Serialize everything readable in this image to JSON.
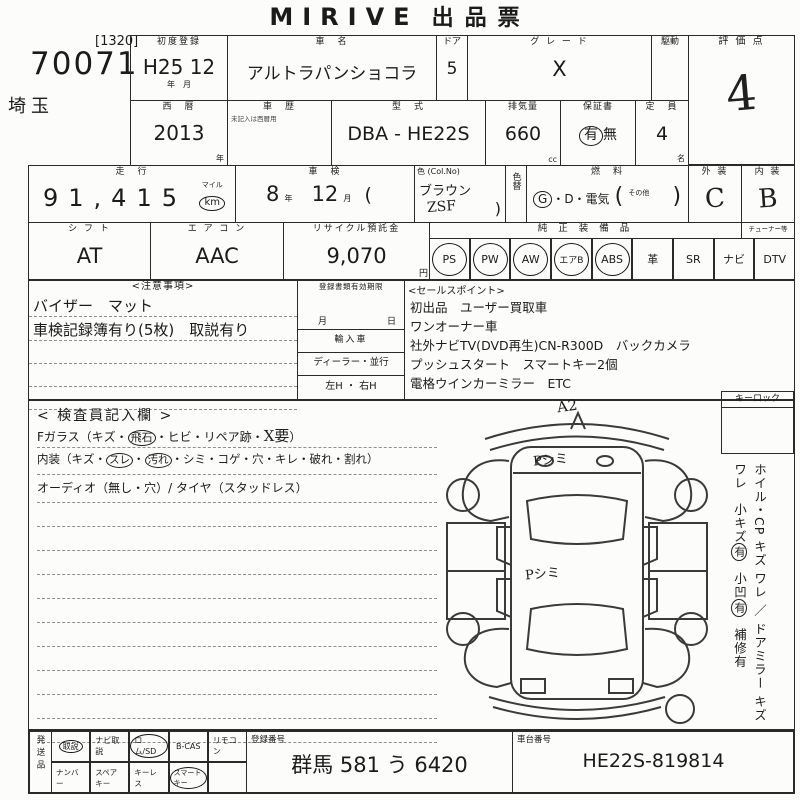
{
  "title": {
    "latin": "MIRIVE",
    "jp": "出品票"
  },
  "corner": {
    "bracket": "[1320]",
    "lot": "70071",
    "pref": "埼玉"
  },
  "r1": {
    "first_reg_label": "初度登録",
    "first_reg": "H25 12",
    "first_reg_unit": "年　月",
    "name_label": "車　名",
    "name": "アルトラパンショコラ",
    "door_label": "ドア",
    "door": "5",
    "grade_label": "グ レ ー ド",
    "grade": "X",
    "drive_label": "駆動",
    "score_label": "評 価 点",
    "score": "4"
  },
  "r2": {
    "year_label": "西　暦",
    "year": "2013",
    "year_unit": "年",
    "hist_label": "車　歴",
    "hist_note": "未記入は西暦用",
    "model_label": "型　式",
    "model": "DBA - HE22S",
    "disp_label": "排気量",
    "disp": "660",
    "disp_unit": "cc",
    "warr_label": "保証書",
    "warr_yes": "有",
    "warr_no": "無",
    "cap_label": "定　員",
    "cap": "4",
    "cap_unit": "名"
  },
  "r3": {
    "run_label": "走　行",
    "run": "91,415",
    "run_unit_a": "マイル",
    "run_unit_b": "km",
    "shaken_label": "車　検",
    "shaken_y": "8",
    "shaken_y_u": "年",
    "shaken_m": "12",
    "shaken_m_u": "月",
    "paren_open": "(",
    "color_label": "色 (Col.No)",
    "color": "ブラウン",
    "color_code": "ZSF",
    "paren_close": ")",
    "recolor_label": "色替",
    "fuel_label": "燃　料",
    "fuel_g": "G",
    "fuel_rest": "・D・電気",
    "fuel_po": "(",
    "fuel_other": "その他",
    "fuel_pc": ")",
    "ext_label": "外 装",
    "ext": "C",
    "int_label": "内 装",
    "int": "B"
  },
  "r4": {
    "shift_label": "シ フ ト",
    "shift": "AT",
    "ac_label": "エ ア コ ン",
    "ac": "AAC",
    "recycle_label": "リサイクル預託金",
    "recycle": "9,070",
    "recycle_unit": "円",
    "equip_label": "純 正 装 備 品",
    "tuner_label": "チューナー等",
    "equip": [
      {
        "label": "PS",
        "on": true
      },
      {
        "label": "PW",
        "on": true
      },
      {
        "label": "AW",
        "on": true
      },
      {
        "label": "エアB",
        "on": true
      },
      {
        "label": "ABS",
        "on": true
      },
      {
        "label": "革",
        "on": false
      },
      {
        "label": "SR",
        "on": false
      },
      {
        "label": "ナビ",
        "on": false
      },
      {
        "label": "DTV",
        "on": false
      }
    ]
  },
  "notes": {
    "label": "<注意事項>",
    "line1": "バイザー　マット",
    "line2": "車検記録簿有り(5枚)　取説有り"
  },
  "docs": {
    "validity_label": "登録書類有効期限",
    "month": "月",
    "day": "日",
    "import_label": "輸入車",
    "dealer": "ディーラー・並行",
    "handle": "左H ・ 右H"
  },
  "sales": {
    "label": "<セールスポイント>",
    "lines": [
      "初出品　ユーザー買取車",
      "ワンオーナー車",
      "社外ナビTV(DVD再生)CN-R300D　バックカメラ",
      "プッシュスタート　スマートキー2個",
      "電格ウインカーミラー　ETC"
    ]
  },
  "inspector": {
    "label": "< 検査員記入欄 >",
    "l1a": "Fガラス（キズ・",
    "l1c": "飛石",
    "l1b": "・ヒビ・リペア跡・",
    "l1h": "X要",
    "l1e": "）",
    "l2a": "内装（キズ・",
    "l2c1": "スレ",
    "l2d": "・",
    "l2c2": "汚れ",
    "l2b": "・シミ・コゲ・穴・キレ・破れ・割れ）",
    "l3": "オーディオ（無し・穴）/ タイヤ（スタッドレス）"
  },
  "diagram": {
    "a2": "A2",
    "p1": "Pシミ",
    "p2": "Pシミ"
  },
  "sidebar": {
    "keylock": "キーロック",
    "wheel": "ホイル・CP キズ ワレ ／ ドアミラー キズ ワレ",
    "s1": "小キズ",
    "s1y": "有",
    "s2": "小凹",
    "s2y": "有",
    "repair": "補修有"
  },
  "bottom": {
    "ship_label": "発送品",
    "row1": [
      {
        "label": "取説",
        "on": true
      },
      {
        "label": "ナビ取説",
        "on": false
      },
      {
        "label": "ロム/SD",
        "on": true
      },
      {
        "label": "B-CAS",
        "on": false
      },
      {
        "label": "リモコン",
        "on": false
      }
    ],
    "row2": [
      {
        "label": "ナンバー",
        "on": false
      },
      {
        "label": "スペアキー",
        "on": false
      },
      {
        "label": "キーレス",
        "on": false
      },
      {
        "label": "スマートキー",
        "on": true
      },
      {
        "label": "",
        "on": false
      }
    ],
    "reg_label": "登録番号",
    "reg": "群馬 581 う 6420",
    "chassis_label": "車台番号",
    "chassis": "HE22S-819814"
  }
}
